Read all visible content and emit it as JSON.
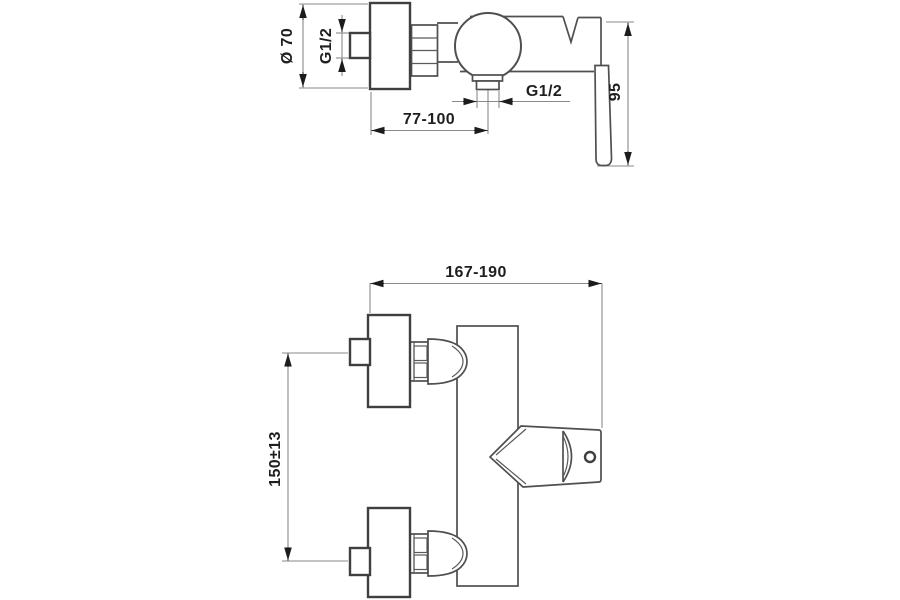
{
  "colors": {
    "background": "#ffffff",
    "part_outline": "#4f4f4f",
    "part_outline_heavy": "#3f3f3f",
    "dimension_line": "#8a8a8a",
    "arrow_and_text": "#1f1f1f"
  },
  "side_view": {
    "flange_diameter": "Ø 70",
    "inlet_thread": "G1/2",
    "outlet_thread": "G1/2",
    "outlet_distance": "77-100",
    "handle_length": "95"
  },
  "front_view": {
    "overall_width": "167-190",
    "inlet_spacing": "150±13"
  }
}
